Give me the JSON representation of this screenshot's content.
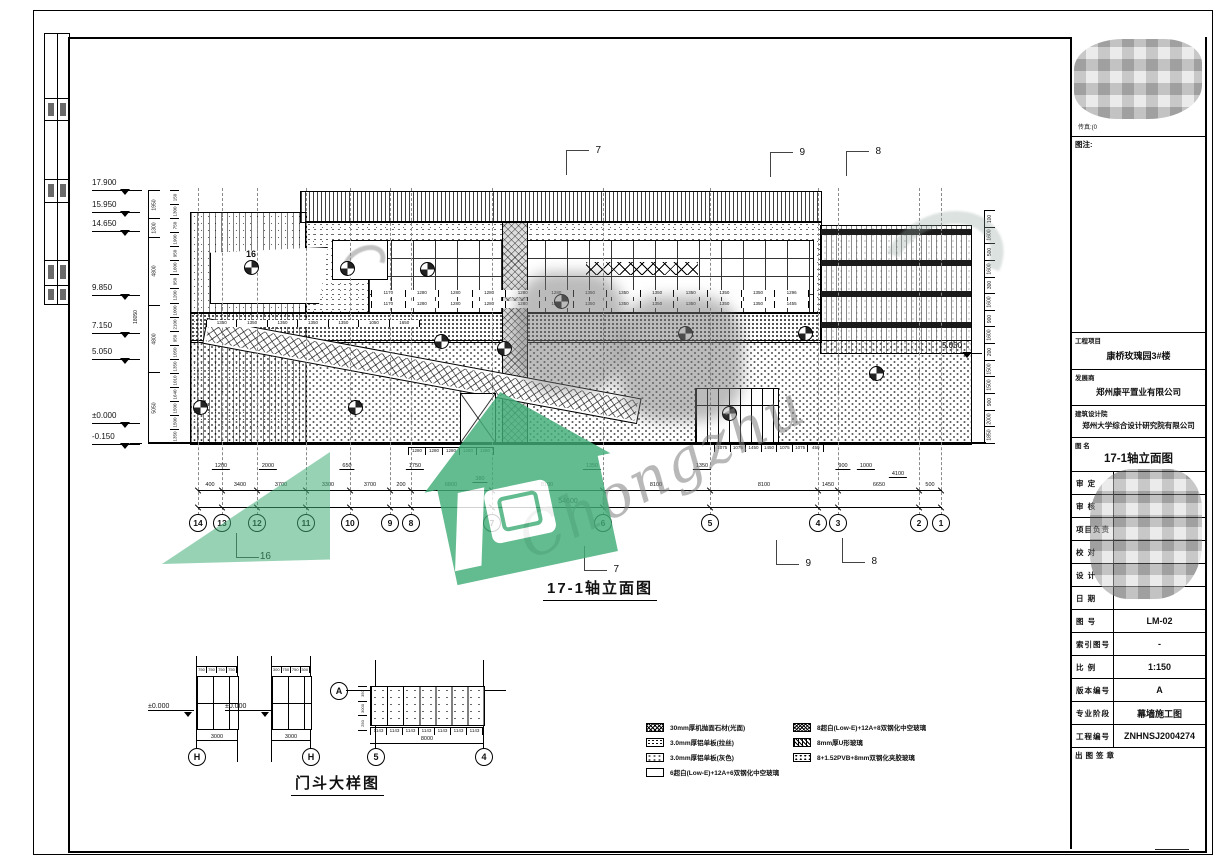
{
  "colors": {
    "green": "#42ad78",
    "line": "#000000",
    "mosaic_grey": "#9a9a9a"
  },
  "watermark": {
    "script_text": "Chongzhu"
  },
  "elevation": {
    "title": "17-1轴立面图",
    "total_width": "54600",
    "total_height": "18050",
    "right_level": "5.050",
    "inner_marker": "16",
    "levels": [
      {
        "t": "17.900",
        "y": 178
      },
      {
        "t": "15.950",
        "y": 200
      },
      {
        "t": "14.650",
        "y": 219
      },
      {
        "t": "9.850",
        "y": 283
      },
      {
        "t": "7.150",
        "y": 321
      },
      {
        "t": "5.050",
        "y": 347
      },
      {
        "t": "±0.000",
        "y": 411
      },
      {
        "t": "-0.150",
        "y": 432
      }
    ],
    "left_chain": [
      {
        "t": "1950",
        "f": "1950"
      },
      {
        "t": "1300",
        "f": "1300"
      },
      {
        "t": "4800",
        "f": "4800"
      },
      {
        "t": "4800",
        "f": "4800"
      },
      {
        "t": "5050",
        "f": "5050"
      }
    ],
    "left_inner_dims": [
      "150",
      "1300",
      "750",
      "1900",
      "950",
      "1600",
      "950",
      "1200",
      "1000",
      "2100",
      "950",
      "1050",
      "1350",
      "1010",
      "1640",
      "1500",
      "1500",
      "1350"
    ],
    "right_dims": [
      "100",
      "1600",
      "500",
      "1600",
      "300",
      "1600",
      "900",
      "1600",
      "200",
      "1500",
      "1500",
      "900",
      "2000",
      "1850"
    ],
    "axes": [
      {
        "n": "14",
        "x": 198
      },
      {
        "n": "13",
        "x": 222
      },
      {
        "n": "12",
        "x": 257
      },
      {
        "n": "11",
        "x": 306
      },
      {
        "n": "10",
        "x": 350
      },
      {
        "n": "9",
        "x": 390
      },
      {
        "n": "8",
        "x": 411
      },
      {
        "n": "7",
        "x": 492
      },
      {
        "n": "6",
        "x": 603
      },
      {
        "n": "5",
        "x": 710
      },
      {
        "n": "4",
        "x": 818
      },
      {
        "n": "3",
        "x": 838
      },
      {
        "n": "2",
        "x": 919
      },
      {
        "n": "1",
        "x": 941
      }
    ],
    "axis_dims": [
      {
        "t": "400",
        "x": 210
      },
      {
        "t": "3400",
        "x": 240
      },
      {
        "t": "3700",
        "x": 281
      },
      {
        "t": "3300",
        "x": 328
      },
      {
        "t": "3700",
        "x": 370
      },
      {
        "t": "200",
        "x": 401
      },
      {
        "t": "6800",
        "x": 451
      },
      {
        "t": "8100",
        "x": 547
      },
      {
        "t": "8100",
        "x": 656
      },
      {
        "t": "8100",
        "x": 764
      },
      {
        "t": "1450",
        "x": 828
      },
      {
        "t": "6650",
        "x": 879
      },
      {
        "t": "500",
        "x": 930
      }
    ],
    "upper_dims": [
      {
        "t": "1200",
        "x": 221,
        "y": 463
      },
      {
        "t": "2000",
        "x": 268,
        "y": 463
      },
      {
        "t": "650",
        "x": 347,
        "y": 463
      },
      {
        "t": "1750",
        "x": 415,
        "y": 463
      },
      {
        "t": "380",
        "x": 480,
        "y": 476
      },
      {
        "t": "1350",
        "x": 592,
        "y": 463
      },
      {
        "t": "1350",
        "x": 702,
        "y": 463
      },
      {
        "t": "900",
        "x": 843,
        "y": 463
      },
      {
        "t": "1000",
        "x": 866,
        "y": 463
      },
      {
        "t": "4100",
        "x": 898,
        "y": 471
      }
    ],
    "panel_dims_top": [
      "1280",
      "1280",
      "1280",
      "1280",
      "1280"
    ],
    "entrance_dims": [
      "1075",
      "1075",
      "1450",
      "1450",
      "1075",
      "1075",
      "450"
    ],
    "window_dims_row": [
      "1170",
      "1280",
      "1280",
      "1280",
      "1280",
      "1280",
      "1350",
      "1350",
      "1350",
      "1350",
      "1350",
      "1350",
      "1296"
    ],
    "window_dims_row2": [
      "1170",
      "1280",
      "1280",
      "1280",
      "1280",
      "1280",
      "1350",
      "1350",
      "1350",
      "1350",
      "1350",
      "1350",
      "1455"
    ],
    "stair_dims": [
      "1350",
      "1350",
      "1350",
      "1350",
      "1350",
      "1050",
      "1650"
    ],
    "section_markers_top": [
      {
        "t": "7",
        "x": 566,
        "y": 150
      },
      {
        "t": "9",
        "x": 770,
        "y": 152
      },
      {
        "t": "8",
        "x": 846,
        "y": 151
      }
    ],
    "section_markers_bottom": [
      {
        "t": "16",
        "x": 236,
        "y": 533
      },
      {
        "t": "7",
        "x": 584,
        "y": 546
      },
      {
        "t": "9",
        "x": 776,
        "y": 540
      },
      {
        "t": "8",
        "x": 842,
        "y": 538
      }
    ],
    "callouts": [
      {
        "x": 244,
        "y": 260
      },
      {
        "x": 340,
        "y": 261
      },
      {
        "x": 420,
        "y": 262
      },
      {
        "x": 497,
        "y": 341
      },
      {
        "x": 678,
        "y": 326
      },
      {
        "x": 798,
        "y": 326
      },
      {
        "x": 869,
        "y": 366
      },
      {
        "x": 722,
        "y": 406
      },
      {
        "x": 348,
        "y": 400
      },
      {
        "x": 193,
        "y": 400
      },
      {
        "x": 434,
        "y": 334
      },
      {
        "x": 554,
        "y": 294
      }
    ]
  },
  "door_detail": {
    "title": "门斗大样图",
    "level_label": "±0.000",
    "panel1_top_dims": [
      "750",
      "750",
      "750",
      "750"
    ],
    "panel2_top_dims": [
      "300",
      "750",
      "750",
      "300"
    ],
    "panel1_total": "3000",
    "panel2_total": "3000",
    "wide_side_dims": [
      "350",
      "3000",
      "250"
    ],
    "wide_bottom_dims": [
      "1143",
      "1143",
      "1143",
      "1143",
      "1143",
      "1143",
      "1143"
    ],
    "wide_total": "8000",
    "bubble_h1": "H",
    "bubble_h2": "H",
    "bubble_a": "A",
    "bubble_5": "5",
    "bubble_4": "4"
  },
  "legend": {
    "left": [
      {
        "text": "30mm厚机抛面石材(光面)",
        "pat": "sw-stone"
      },
      {
        "text": "3.0mm厚铝单板(拉丝)",
        "pat": "sw-alum1"
      },
      {
        "text": "3.0mm厚铝单板(灰色)",
        "pat": "sw-alum2"
      },
      {
        "text": "6超白(Low-E)+12A+6双钢化中空玻璃",
        "pat": "sw-plain"
      }
    ],
    "right": [
      {
        "text": "8超白(Low-E)+12A+8双钢化中空玻璃",
        "pat": "sw-dense"
      },
      {
        "text": "8mm厚U形玻璃",
        "pat": "sw-uglass"
      },
      {
        "text": "8+1.52PVB+8mm双钢化夹胶玻璃",
        "pat": "sw-lam"
      }
    ]
  },
  "title_block": {
    "fax_line": "传真:(0",
    "note_label": "图注:",
    "project_label": "工程项目",
    "project_value": "康桥玫瑰园3#楼",
    "developer_label": "发展商",
    "developer_value": "郑州康平置业有限公司",
    "designer_label": "建筑设计院",
    "designer_value": "郑州大学综合设计研究院有限公司",
    "dwgname_label": "图 名",
    "dwgname_value": "17-1轴立面图",
    "sign_rows": [
      {
        "label": "审 定"
      },
      {
        "label": "审 核"
      },
      {
        "label": "项目负责"
      },
      {
        "label": "校 对"
      },
      {
        "label": "设 计"
      },
      {
        "label": "日 期"
      }
    ],
    "info_rows": [
      {
        "label": "图 号",
        "value": "LM-02"
      },
      {
        "label": "索引图号",
        "value": "-"
      },
      {
        "label": "比 例",
        "value": "1:150"
      },
      {
        "label": "版本编号",
        "value": "A"
      },
      {
        "label": "专业阶段",
        "value": "幕墙施工图"
      },
      {
        "label": "工程编号",
        "value": "ZNHNSJ2004274"
      }
    ],
    "seal_label": "出图签章"
  }
}
